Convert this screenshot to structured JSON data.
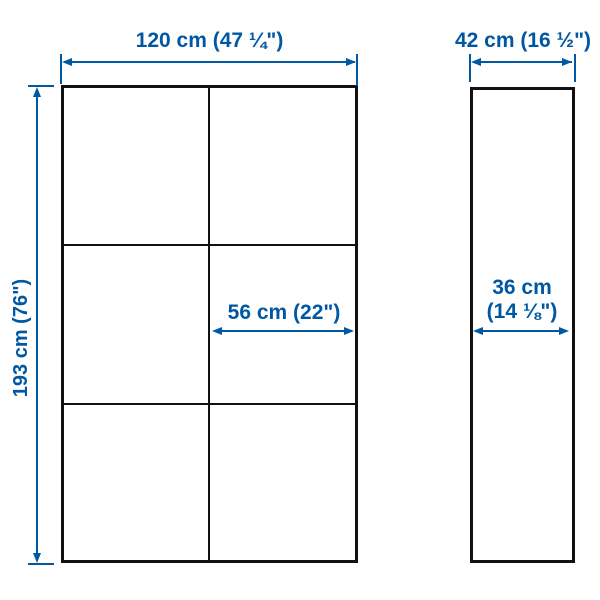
{
  "front_view": {
    "width_label": "120 cm (47 ¼\")",
    "height_label": "193 cm (76\")",
    "inner_width_label": "56 cm (22\")",
    "columns": 2,
    "rows": 3
  },
  "side_view": {
    "depth_label": "42 cm (16 ½\")",
    "inner_depth_label_line1": "36 cm",
    "inner_depth_label_line2": "(14 ⅛\")"
  },
  "colors": {
    "accent": "#0058A3",
    "line": "#111111",
    "background": "#ffffff"
  }
}
